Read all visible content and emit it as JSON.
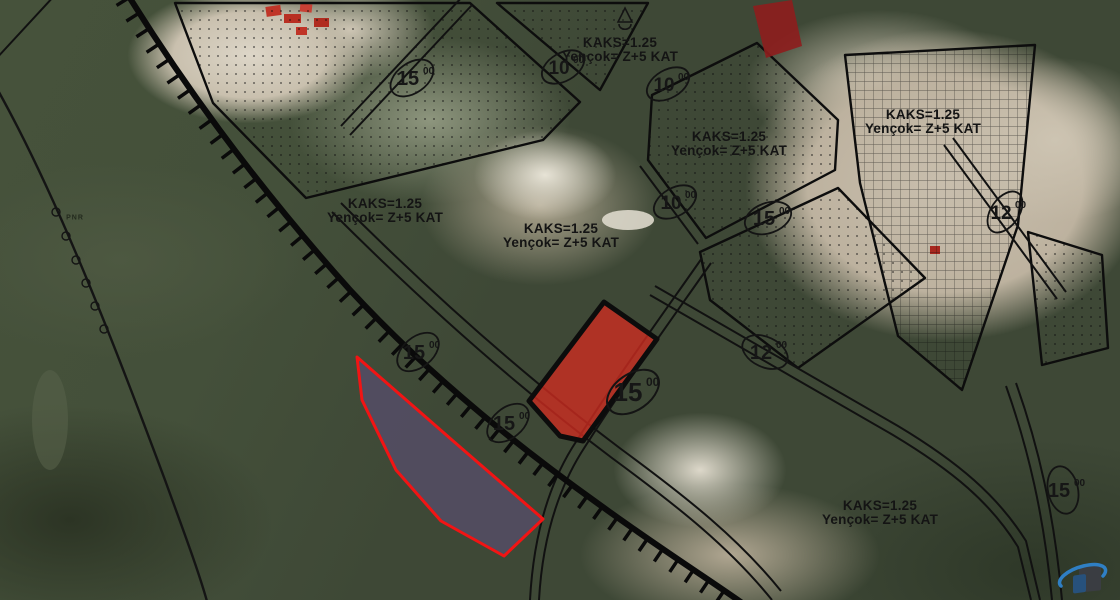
{
  "map": {
    "description": "Satellite imagery with urban zoning plan overlay",
    "zoning_labels": [
      {
        "line1": "KAKS=1.25",
        "line2": "Yençok= Z+5 KAT"
      },
      {
        "line1": "KAKS=1.25",
        "line2": "Yençok= Z+5 KAT"
      },
      {
        "line1": "KAKS=1.25",
        "line2": "Yençok= Z+5 KAT"
      },
      {
        "line1": "KAKS=1.25",
        "line2": "Yençok= Z+5 KAT"
      },
      {
        "line1": "KAKS=1.25",
        "line2": "Yençok= Z+5 KAT"
      },
      {
        "line1": "KAKS=1.25",
        "line2": "Yençok= Z+5 KAT"
      }
    ],
    "road_width_markers": [
      {
        "value": "15",
        "sup": "00"
      },
      {
        "value": "10",
        "sup": "00"
      },
      {
        "value": "10",
        "sup": "00"
      },
      {
        "value": "10",
        "sup": "00"
      },
      {
        "value": "15",
        "sup": "00"
      },
      {
        "value": "12",
        "sup": "00"
      },
      {
        "value": "12",
        "sup": "00"
      },
      {
        "value": "15",
        "sup": "00"
      },
      {
        "value": "15",
        "sup": "00"
      },
      {
        "value": "15",
        "sup": "00"
      },
      {
        "value": "15",
        "sup": "00"
      }
    ],
    "ground_text": "PNR",
    "colors": {
      "highlight_parcel_fill": "#cf2b20",
      "highlight_parcel_stroke": "#0c0c0c",
      "outlined_parcel_fill": "#564d68",
      "outlined_parcel_stroke": "#f21414",
      "small_parcel_fill": "#8e1d1d",
      "plan_line": "#0d0d0d",
      "logo_blue": "#2f7fc4"
    }
  }
}
